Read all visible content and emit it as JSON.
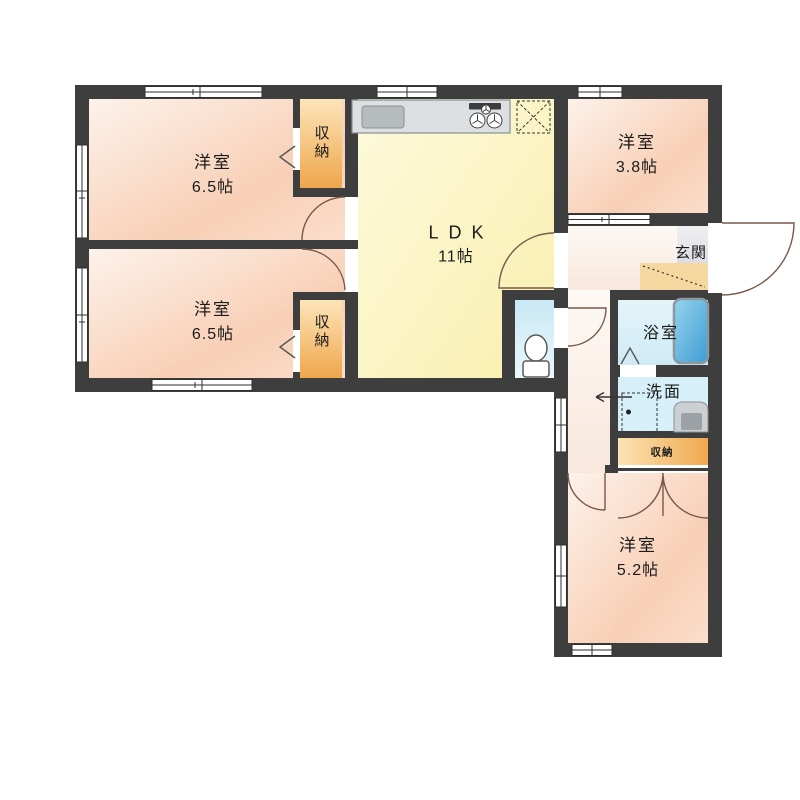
{
  "rooms": {
    "bedroom_nw": {
      "name": "洋室",
      "size": "6.5帖"
    },
    "bedroom_sw": {
      "name": "洋室",
      "size": "6.5帖"
    },
    "bedroom_ne": {
      "name": "洋室",
      "size": "3.8帖"
    },
    "bedroom_se": {
      "name": "洋室",
      "size": "5.2帖"
    },
    "ldk": {
      "name": "LDK",
      "size": "11帖"
    },
    "entrance": {
      "name": "玄関"
    },
    "bathroom": {
      "name": "浴室"
    },
    "washroom": {
      "name": "洗面"
    },
    "closet_north": {
      "name": "収納"
    },
    "closet_south": {
      "name": "収納"
    },
    "closet_east": {
      "name": "収納"
    }
  },
  "palette": {
    "wall": "#3e3e3e",
    "room_pink": "#f8cdb3",
    "ldk_yellow": "#f9efad",
    "closet_orange": "#f0a94e",
    "wet_area_blue": "#d4eef8",
    "bathtub_blue": "#3f9cd4",
    "entrance_step": "#f4d89f",
    "door_arc": "#7a584a"
  },
  "fixture_icons": [
    "kitchen-counter-icon",
    "kitchen-sink-icon",
    "stove-icon",
    "refrigerator-space-icon",
    "bathtub-icon",
    "toilet-icon",
    "washbasin-icon",
    "washing-machine-space-icon"
  ]
}
